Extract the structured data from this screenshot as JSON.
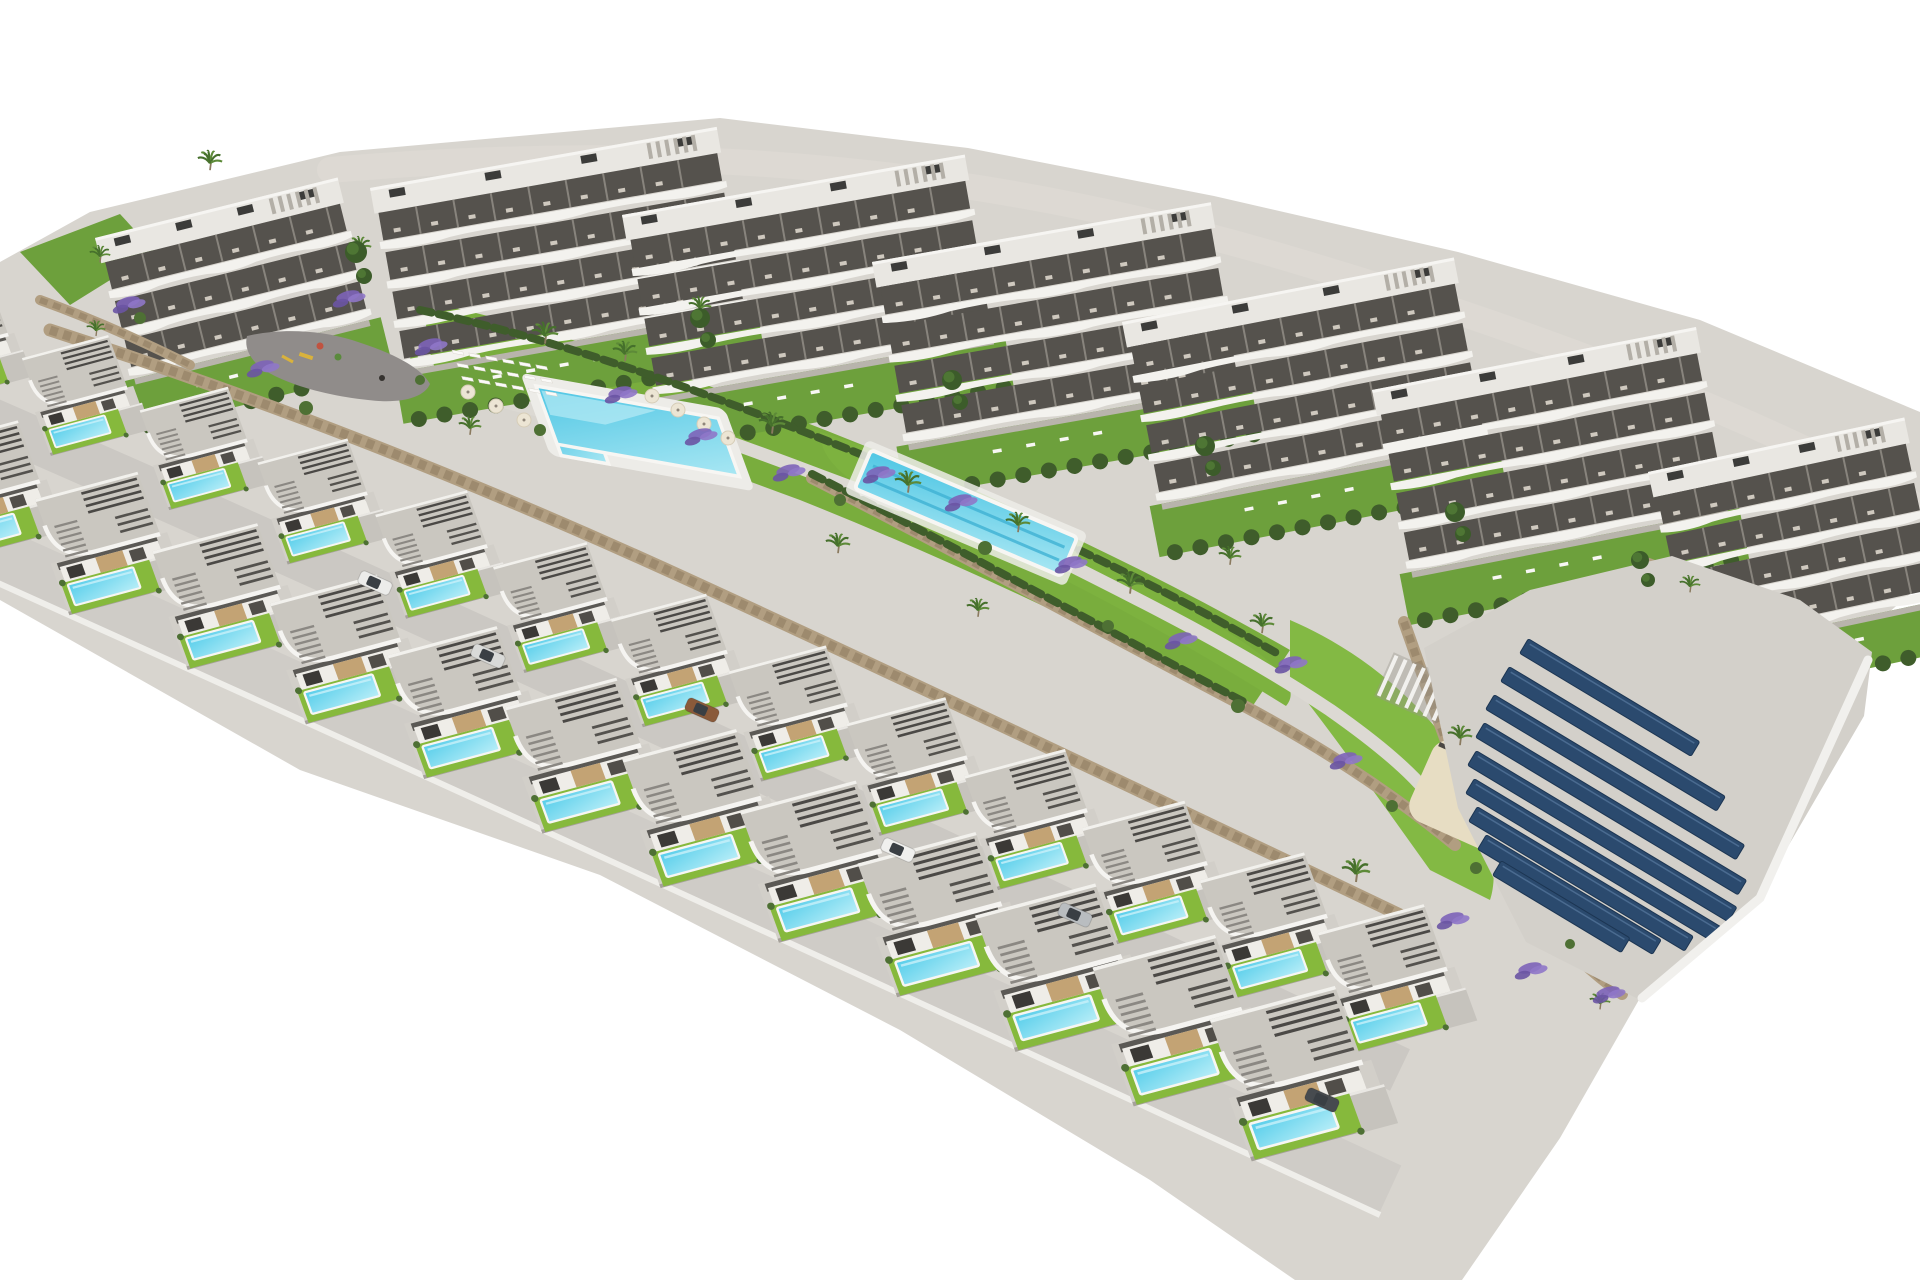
{
  "meta": {
    "title": "Aerial 3D render — residential development with apartments, pool villas and solar field",
    "canvas": {
      "w": 1920,
      "h": 1280
    },
    "background": "#ffffff"
  },
  "palette": {
    "terrain": "#d8d5cf",
    "topRoad": "#ddd9d3",
    "roadMid": "#cbc8c3",
    "roadFront": "#cfccc7",
    "roadEdge": "#efeeea",
    "plaza": "#908c8a",
    "walk": "#dcd9d3",
    "lawnA": "#79ad3d",
    "lawnB": "#7db23f",
    "lawnC": "#83b944",
    "lawnD": "#6da03c",
    "villaLawn": "#86b93c",
    "hedge": "#3f5d2b",
    "tree": "#3c5c2a",
    "treeIn": "#4e7634",
    "shrub": "#4e7034",
    "wallTan": "#b19e81",
    "wallDark": "#8d7a5e",
    "bldRoof": "#e9e7e2",
    "bldParapet": "#f6f5f2",
    "bldRecess": "#55524d",
    "bldDeck": "#f3f2ee",
    "bldDivider": "#88847d",
    "bldBase": "#b8b4ac",
    "ac": "#3c3c3a",
    "roofSlatLight": "#b3afa7",
    "villaRoof": "#cac7c0",
    "villaFascia": "#f5f4f1",
    "villaWall": "#efede8",
    "villaTan": "#c3a374",
    "villaDarkA": "#3b3936",
    "villaDarkB": "#514e49",
    "villaBand": "#5b5955",
    "platform": "#d2cfc9",
    "platformEdge": "#a5a19a",
    "driveway": "#c6c3bd",
    "curb": "#e9e7e3",
    "slat": "#4b4946",
    "slat2": "#54524e",
    "stair": "#8b8883",
    "poolHi": "#c9f1fa",
    "poolRim": "#f7f6f3",
    "poolTop": "#55cdea",
    "poolBot": "#b9eef8",
    "pool2Top": "#4fc6e4",
    "pool2Bot": "#a9e7f3",
    "lapLane": "#3fb2d4",
    "deckWhite": "#edece8",
    "loungerWhite": "#fbfaf8",
    "loungerDark": "#4a4744",
    "parasol": "#ece5d4",
    "parasolEdge": "#d6cdb8",
    "sand": "#e7ddc3",
    "solar": "#2b4a6e",
    "solarEdge": "#1c3552",
    "solarHi": "#58799f",
    "solarTerrace": "#d3d0ca",
    "trunk": "#8a7a5f",
    "palm": "#46702c",
    "palmLight": "#5d8a38",
    "lavA": "#7d63b8",
    "lavB": "#8f77c8",
    "lavC": "#6a54a3",
    "carGlass": "#3a3f44",
    "equipYellow": "#d9b23c",
    "equipRed": "#c05340",
    "equipGreen": "#5a8a3c",
    "person": "#35322f",
    "pergolaShadow": "#9a968e"
  },
  "scene": {
    "terrainPath": "M 0,262 L 90,212 L 340,152 L 720,118 L 968,148 L 1214,196 L 1458,252 L 1700,320 L 1920,412 L 1920,585 L 1878,622 L 1790,700 L 1680,928 L 1560,1138 L 1462,1280 L 1295,1280 L 1150,1180 L 900,1030 L 600,875 L 300,770 L 0,600 Z",
    "topRoadPath": "M 330,170 C 700,138 1000,172 1300,262 C 1550,336 1760,420 1915,505",
    "lawns": [
      {
        "d": "M 20,252 L 120,214 L 155,252 L 70,305 Z",
        "c": "lawnD"
      },
      {
        "d": "M 420,300 C 560,330 700,380 850,440 C 1000,500 1150,570 1290,650 L 1250,710 C 1100,630 950,560 800,500 C 650,445 520,395 410,360 Z",
        "c": "lawnA"
      },
      {
        "d": "M 820,432 C 980,480 1120,560 1240,640 C 1282,668 1300,690 1286,706 C 1180,640 1040,560 900,505 C 852,486 820,462 820,432 Z",
        "c": "lawnB"
      },
      {
        "d": "M 1290,620 C 1360,650 1420,700 1460,760 C 1490,820 1500,870 1490,900 L 1430,870 C 1380,800 1330,730 1290,680 Z",
        "c": "lawnC"
      },
      {
        "d": "M 1680,560 L 1800,610 L 1860,660 L 1800,700 L 1690,640 Z",
        "c": "lawnD"
      }
    ],
    "walkways": [
      "M 424,246 C 420,290 414,330 428,368",
      "M 430,382 C 470,394 505,402 545,412",
      "M 700,432 C 760,452 830,480 900,505",
      "M 1060,560 C 1140,600 1240,650 1330,710 C 1380,745 1408,770 1425,790"
    ],
    "buildings": [
      {
        "x": 95,
        "y": 238,
        "w": 250,
        "floors": 3,
        "rot": -14
      },
      {
        "x": 370,
        "y": 188,
        "w": 352,
        "floors": 4,
        "rot": -10
      },
      {
        "x": 622,
        "y": 215,
        "w": 348,
        "floors": 4,
        "rot": -10
      },
      {
        "x": 872,
        "y": 262,
        "w": 344,
        "floors": 4,
        "rot": -10
      },
      {
        "x": 1122,
        "y": 322,
        "w": 338,
        "floors": 4,
        "rot": -11
      },
      {
        "x": 1372,
        "y": 390,
        "w": 330,
        "floors": 4,
        "rot": -11
      },
      {
        "x": 1648,
        "y": 472,
        "w": 262,
        "floors": 4,
        "rot": -12
      }
    ],
    "plaza": {
      "d": "M 247,336 C 280,328 320,330 352,340 C 390,352 420,366 430,384 C 424,398 400,404 368,400 C 330,396 290,386 264,370 C 250,360 244,348 247,336 Z",
      "yellowBar": [
        300,
        352
      ],
      "redDot": [
        320,
        346
      ],
      "greenDot": [
        338,
        357
      ],
      "slide": [
        282,
        356
      ],
      "person": [
        382,
        378
      ]
    },
    "walls": [
      {
        "d": "M 50,330 C 250,395 450,470 700,585 C 950,700 1180,810 1400,915",
        "w": 13
      },
      {
        "d": "M 812,478 C 950,548 1095,628 1248,708 C 1330,752 1400,800 1455,845",
        "w": 12
      },
      {
        "d": "M 1404,622 C 1428,688 1448,756 1482,826 C 1512,888 1560,950 1622,994",
        "w": 12
      },
      {
        "d": "M 1640,560 C 1700,580 1760,612 1810,650",
        "w": 10
      },
      {
        "d": "M 40,300 C 90,318 140,340 190,365",
        "w": 10
      }
    ],
    "hedges": [
      {
        "d": "M 420,310 C 560,340 700,390 850,450 C 1000,510 1150,580 1280,655",
        "w": 8
      },
      {
        "d": "M 812,474 C 950,544 1095,624 1248,704",
        "w": 8
      }
    ],
    "communalPool": {
      "x": 536,
      "y": 386,
      "deck": [
        -12,
        -12,
        208,
        88
      ],
      "water": [
        0,
        0,
        185,
        62
      ],
      "ext": [
        0,
        34,
        48,
        40
      ],
      "sheen": "4,4 120,4 60,30 4,30"
    },
    "loungerGrid": {
      "x": 452,
      "y": 350,
      "rows": 3,
      "cols": 6,
      "dx": 17,
      "dy": 14,
      "w": 11,
      "h": 3.5
    },
    "parasols": [
      [
        468,
        392
      ],
      [
        496,
        406
      ],
      [
        524,
        420
      ],
      [
        652,
        396
      ],
      [
        678,
        410
      ],
      [
        704,
        424
      ],
      [
        728,
        438
      ]
    ],
    "lapPool": {
      "x": 966,
      "y": 513,
      "rot": 23,
      "len": 224,
      "wid": 42
    },
    "pergola": {
      "x": 1415,
      "y": 688,
      "rot": 24,
      "slats": 7
    },
    "sand": {
      "x": 1478,
      "y": 800,
      "w": 124,
      "h": 88,
      "rot": 24
    },
    "darkLoungers": {
      "x": 1440,
      "y": 742,
      "n": 7,
      "dx": 11.5,
      "dy": 6.5,
      "rot": 24
    },
    "solar": {
      "terrace": "M 1424,648 L 1530,590 L 1672,556 L 1800,600 L 1872,652 L 1864,716 L 1758,898 L 1640,1000 L 1526,942 L 1458,808 Z",
      "rim": "M 1868,660 L 1760,898 L 1642,998",
      "angle": 31,
      "bars": [
        [
          1524,
          646,
          200
        ],
        [
          1505,
          674,
          252
        ],
        [
          1490,
          702,
          292
        ],
        [
          1480,
          730,
          306
        ],
        [
          1472,
          758,
          304
        ],
        [
          1470,
          786,
          288
        ],
        [
          1473,
          814,
          252
        ],
        [
          1482,
          842,
          204
        ],
        [
          1497,
          868,
          150
        ]
      ]
    },
    "roads": {
      "between": {
        "d": "M -80,390 Q 500,640 1400,1070",
        "w": 46
      },
      "front": {
        "d": "M -80,520 Q 500,780 1390,1190",
        "w": 54
      },
      "frontEdge": {
        "d": "M -80,548 Q 500,808 1380,1215",
        "w": 6
      }
    },
    "villas": {
      "matrix": "0.966 -0.259 0.342 0.940 0 0",
      "back": [
        [
          -39,
          342,
          0.62
        ],
        [
          80,
          395,
          0.62
        ],
        [
          199,
          448,
          0.633
        ],
        [
          318,
          501,
          0.646
        ],
        [
          437,
          554,
          0.659
        ],
        [
          556,
          607,
          0.672
        ],
        [
          675,
          660,
          0.685
        ],
        [
          794,
          713,
          0.698
        ],
        [
          913,
          766,
          0.711
        ],
        [
          1032,
          819,
          0.724
        ],
        [
          1151,
          872,
          0.737
        ],
        [
          1270,
          925,
          0.75
        ],
        [
          1389,
          978,
          0.763
        ]
      ],
      "front": [
        [
          -15,
          490,
          0.72
        ],
        [
          104,
          543,
          0.736
        ],
        [
          223,
          596,
          0.752
        ],
        [
          342,
          649,
          0.768
        ],
        [
          461,
          702,
          0.784
        ],
        [
          580,
          755,
          0.8
        ],
        [
          699,
          808,
          0.816
        ],
        [
          818,
          861,
          0.832
        ],
        [
          937,
          914,
          0.848
        ],
        [
          1056,
          967,
          0.864
        ],
        [
          1175,
          1020,
          0.88
        ],
        [
          1294,
          1073,
          0.9
        ]
      ]
    },
    "palms": [
      [
        210,
        165,
        13
      ],
      [
        100,
        258,
        11
      ],
      [
        360,
        250,
        12
      ],
      [
        545,
        338,
        14
      ],
      [
        625,
        356,
        13
      ],
      [
        700,
        310,
        12
      ],
      [
        772,
        428,
        14
      ],
      [
        908,
        487,
        14
      ],
      [
        1018,
        527,
        13
      ],
      [
        1130,
        588,
        14
      ],
      [
        1262,
        628,
        13
      ],
      [
        1230,
        560,
        12
      ],
      [
        1356,
        876,
        15
      ],
      [
        1460,
        740,
        13
      ],
      [
        470,
        430,
        12
      ],
      [
        838,
        548,
        13
      ],
      [
        978,
        612,
        12
      ],
      [
        1690,
        588,
        11
      ],
      [
        1600,
        1005,
        11
      ],
      [
        96,
        332,
        10
      ]
    ],
    "lavender": [
      [
        128,
        302
      ],
      [
        262,
        366
      ],
      [
        348,
        296
      ],
      [
        430,
        344
      ],
      [
        620,
        392
      ],
      [
        700,
        434
      ],
      [
        788,
        470
      ],
      [
        878,
        472
      ],
      [
        960,
        500
      ],
      [
        1070,
        562
      ],
      [
        1180,
        638
      ],
      [
        1290,
        662
      ],
      [
        1345,
        758
      ],
      [
        1452,
        918
      ],
      [
        1530,
        968
      ],
      [
        1608,
        992
      ]
    ],
    "shrubs": [
      [
        140,
        318,
        6
      ],
      [
        306,
        408,
        7
      ],
      [
        540,
        430,
        6
      ],
      [
        985,
        548,
        7
      ],
      [
        1108,
        626,
        6
      ],
      [
        1238,
        706,
        7
      ],
      [
        1392,
        806,
        6
      ],
      [
        1476,
        868,
        6
      ],
      [
        1570,
        944,
        5
      ],
      [
        420,
        380,
        5
      ],
      [
        840,
        500,
        6
      ]
    ],
    "trees": [
      [
        356,
        252,
        11
      ],
      [
        364,
        276,
        8
      ],
      [
        700,
        318,
        10
      ],
      [
        708,
        340,
        8
      ],
      [
        952,
        380,
        10
      ],
      [
        960,
        402,
        8
      ],
      [
        1205,
        446,
        10
      ],
      [
        1213,
        468,
        8
      ],
      [
        1455,
        512,
        10
      ],
      [
        1463,
        534,
        8
      ],
      [
        1640,
        560,
        9
      ],
      [
        1648,
        580,
        7
      ]
    ],
    "cars": [
      [
        375,
        583,
        "#ececea"
      ],
      [
        488,
        656,
        "#d9dad8"
      ],
      [
        702,
        710,
        "#8a5a3a"
      ],
      [
        898,
        850,
        "#f0f0ee"
      ],
      [
        1075,
        915,
        "#b9bdc0"
      ],
      [
        1322,
        1100,
        "#474b4f"
      ]
    ]
  }
}
